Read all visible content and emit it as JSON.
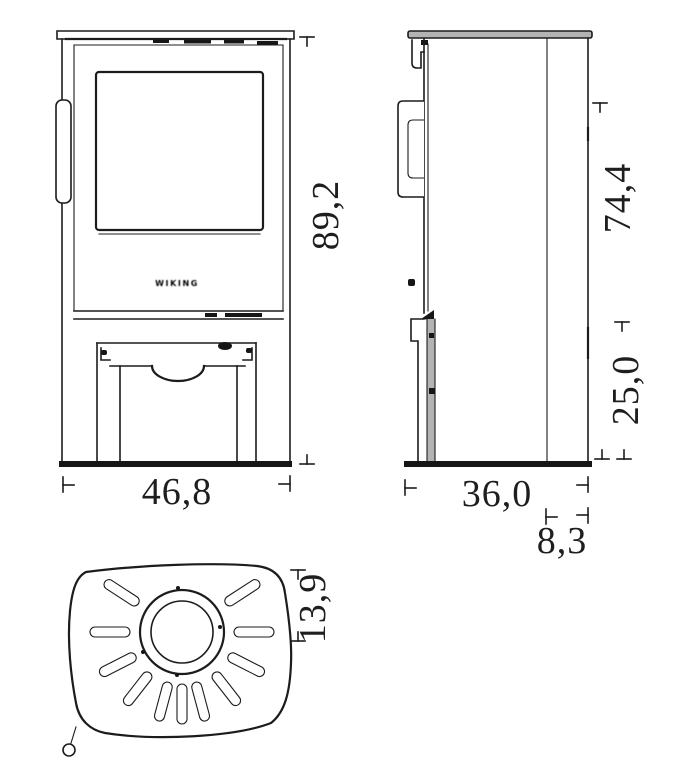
{
  "title": "Wood stove dimensional drawing — front, side and top views",
  "units": "cm",
  "brand": {
    "logo": "WIKING"
  },
  "colors": {
    "line": "#1c1c1c",
    "metal_gray": "#b3b3b3",
    "background": "#ffffff"
  },
  "views": {
    "front": {
      "label": "front view",
      "dimensions": {
        "height": "89,2",
        "width": "46,8"
      }
    },
    "side": {
      "label": "side view",
      "dimensions": {
        "upper_height": "74,4",
        "base_height": "25,0",
        "depth": "36,0",
        "rear_offset": "8,3"
      }
    },
    "top": {
      "label": "top view",
      "dimensions": {
        "flue_center_from_rear": "13,9"
      }
    }
  }
}
